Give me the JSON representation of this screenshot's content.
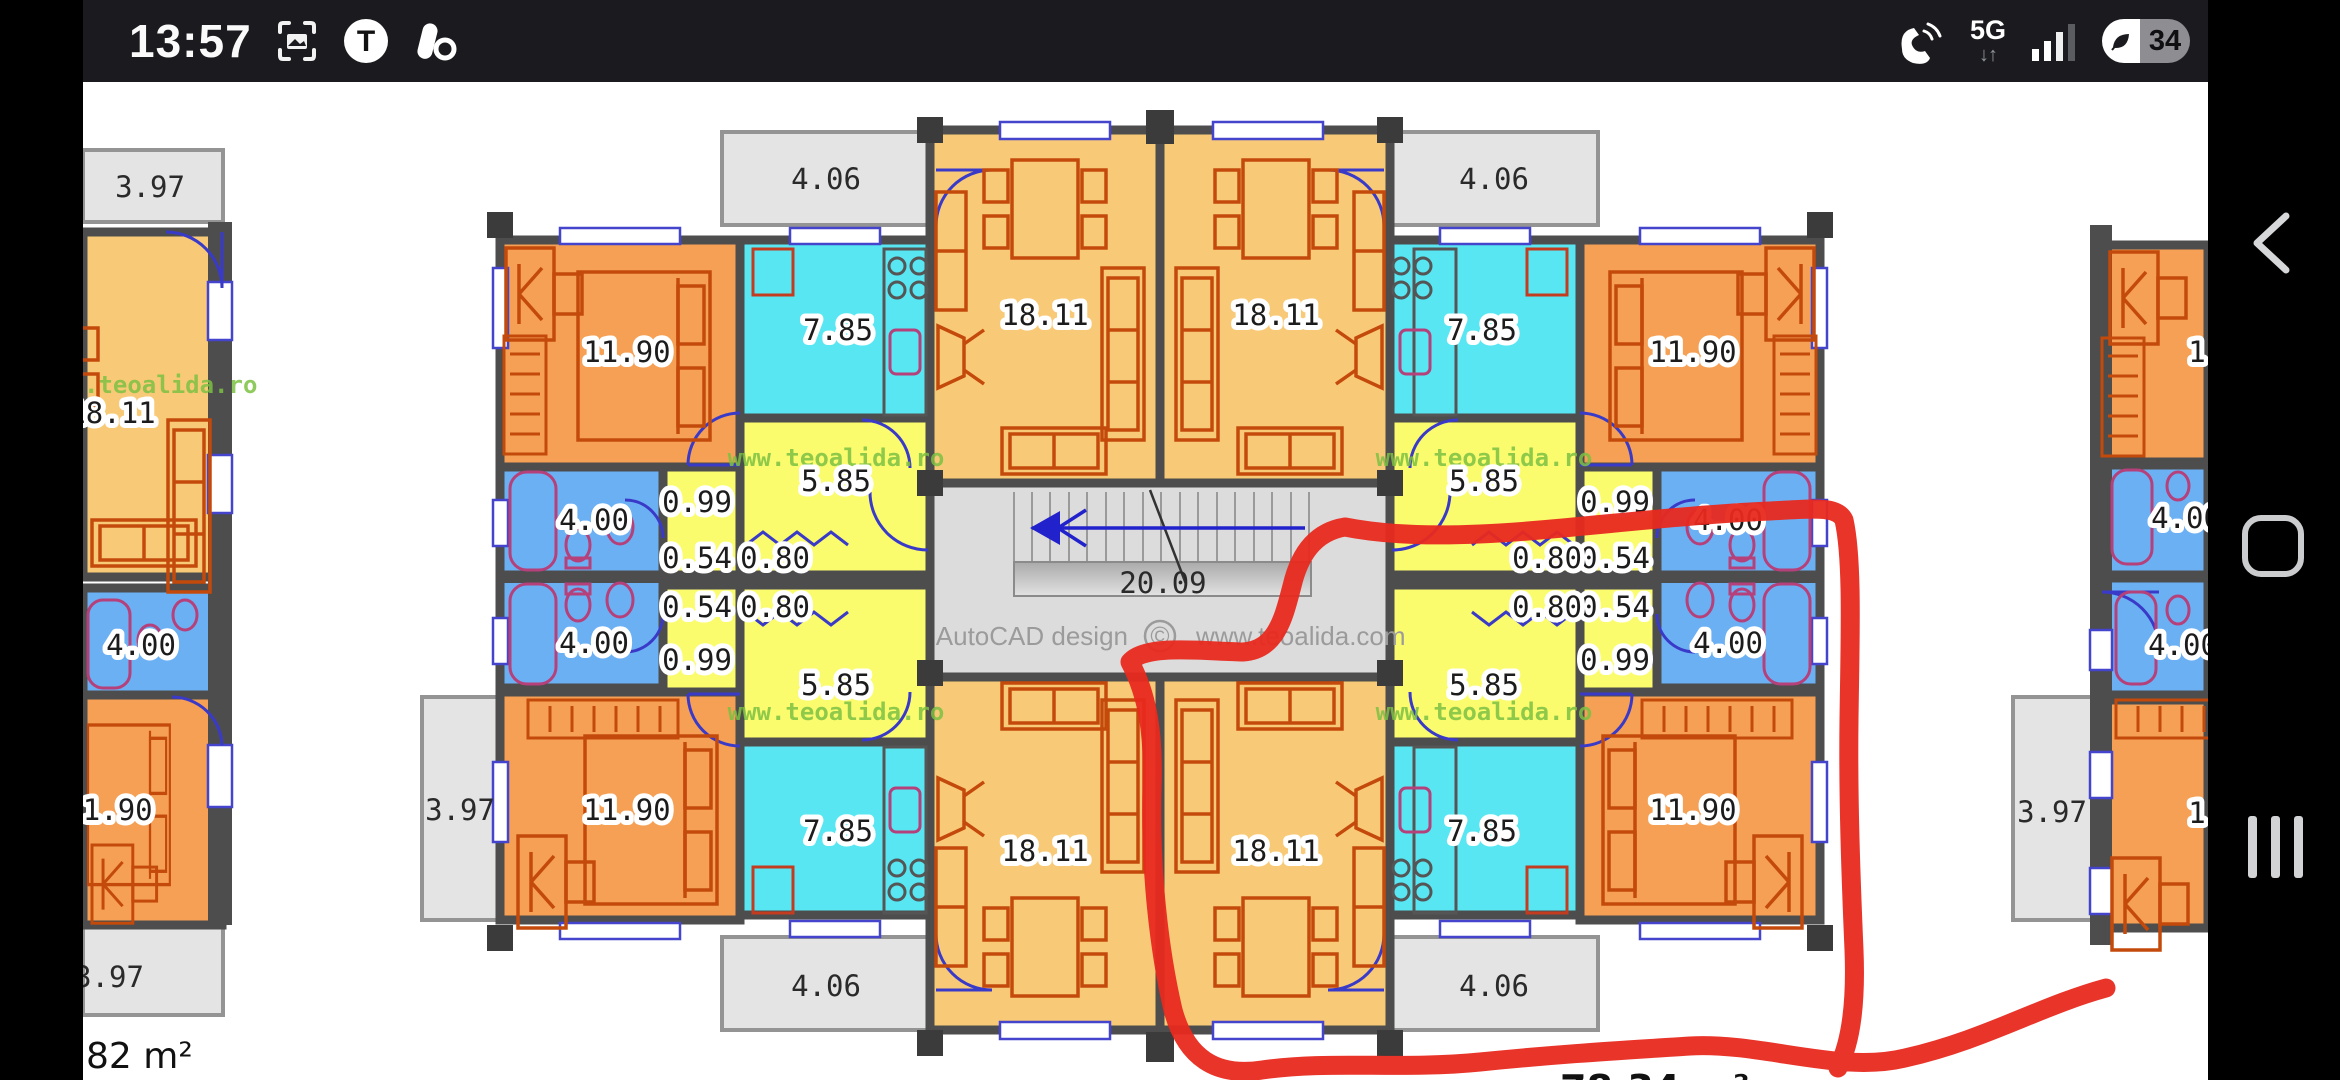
{
  "status_bar": {
    "time": "13:57",
    "icons": {
      "t_badge": "T"
    },
    "right": {
      "network": "5G",
      "net_arrows": "↓↑",
      "battery_percent": "34"
    }
  },
  "plan": {
    "labels": {
      "living": "18.11",
      "bedroom": "11.90",
      "kitchen": "7.85",
      "hall": "5.85",
      "bath": "4.00",
      "balcony_front": "4.06",
      "balcony_side": "3.97",
      "niche": "0.99",
      "w054": "0.54",
      "w080": "0.80",
      "stair_run": "20.09",
      "partial_one": "1"
    },
    "watermark": "www.teoalida.ro",
    "watermark_partial": ".teoalida.ro",
    "credit": "AutoCAD design",
    "copyright": "©",
    "credit_site": "www.teoalida.com",
    "area": "82 m²",
    "bottom_partial": "78.34 m²"
  }
}
